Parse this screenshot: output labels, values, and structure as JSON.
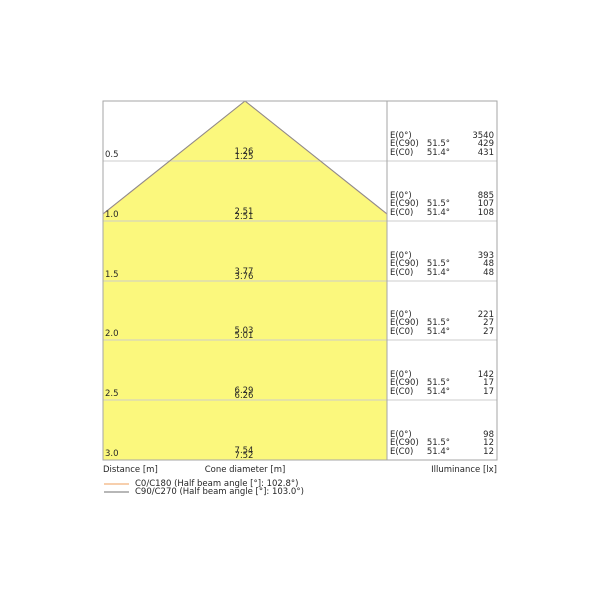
{
  "diagram": {
    "axis": {
      "distance_label": "Distance [m]",
      "cone_label": "Cone diameter [m]",
      "illuminance_label": "Illuminance [lx]"
    },
    "rows": [
      {
        "distance": "0.5",
        "cone_c90": "1.26",
        "cone_c0": "1.25",
        "e0_label": "E(0°)",
        "e0_value": "3540",
        "ec90_label": "E(C90)",
        "ec90_angle": "51.5°",
        "ec90_value": "429",
        "ec0_label": "E(C0)",
        "ec0_angle": "51.4°",
        "ec0_value": "431"
      },
      {
        "distance": "1.0",
        "cone_c90": "2.51",
        "cone_c0": "2.51",
        "e0_label": "E(0°)",
        "e0_value": "885",
        "ec90_label": "E(C90)",
        "ec90_angle": "51.5°",
        "ec90_value": "107",
        "ec0_label": "E(C0)",
        "ec0_angle": "51.4°",
        "ec0_value": "108"
      },
      {
        "distance": "1.5",
        "cone_c90": "3.77",
        "cone_c0": "3.76",
        "e0_label": "E(0°)",
        "e0_value": "393",
        "ec90_label": "E(C90)",
        "ec90_angle": "51.5°",
        "ec90_value": "48",
        "ec0_label": "E(C0)",
        "ec0_angle": "51.4°",
        "ec0_value": "48"
      },
      {
        "distance": "2.0",
        "cone_c90": "5.03",
        "cone_c0": "5.01",
        "e0_label": "E(0°)",
        "e0_value": "221",
        "ec90_label": "E(C90)",
        "ec90_angle": "51.5°",
        "ec90_value": "27",
        "ec0_label": "E(C0)",
        "ec0_angle": "51.4°",
        "ec0_value": "27"
      },
      {
        "distance": "2.5",
        "cone_c90": "6.29",
        "cone_c0": "6.26",
        "e0_label": "E(0°)",
        "e0_value": "142",
        "ec90_label": "E(C90)",
        "ec90_angle": "51.5°",
        "ec90_value": "17",
        "ec0_label": "E(C0)",
        "ec0_angle": "51.4°",
        "ec0_value": "17"
      },
      {
        "distance": "3.0",
        "cone_c90": "7.54",
        "cone_c0": "7.52",
        "e0_label": "E(0°)",
        "e0_value": "98",
        "ec90_label": "E(C90)",
        "ec90_angle": "51.5°",
        "ec90_value": "12",
        "ec0_label": "E(C0)",
        "ec0_angle": "51.4°",
        "ec0_value": "12"
      }
    ],
    "legend": [
      {
        "label": "C0/C180 (Half beam angle [°]: 102.8°)",
        "color": "#f2b27c"
      },
      {
        "label": "C90/C270 (Half beam angle [°]: 103.0°)",
        "color": "#8c8c8c"
      }
    ],
    "colors": {
      "cone_fill": "#fbf87d",
      "c0_line": "#f2b27c",
      "c90_line": "#8c8c8c"
    }
  },
  "chart_data": {
    "type": "area",
    "title": "Luminous cone diagram",
    "axis_labels": [
      "Distance [m]",
      "Cone diameter [m]",
      "Illuminance [lx]"
    ],
    "distance_m": [
      0.5,
      1.0,
      1.5,
      2.0,
      2.5,
      3.0
    ],
    "series": [
      {
        "name": "C0/C180",
        "half_beam_angle_deg": 102.8,
        "angle_label": "51.4°",
        "cone_diameter_m": [
          1.25,
          2.51,
          3.76,
          5.01,
          6.26,
          7.52
        ],
        "illuminance_lx": [
          431,
          108,
          48,
          27,
          17,
          17
        ],
        "color": "#f2b27c"
      },
      {
        "name": "C90/C270",
        "half_beam_angle_deg": 103.0,
        "angle_label": "51.5°",
        "cone_diameter_m": [
          1.26,
          2.51,
          3.77,
          5.03,
          6.29,
          7.54
        ],
        "illuminance_lx": [
          429,
          107,
          48,
          27,
          17,
          12
        ],
        "color": "#8c8c8c"
      },
      {
        "name": "E(0°)",
        "illuminance_lx": [
          3540,
          885,
          393,
          221,
          142,
          98
        ]
      }
    ],
    "grid": true,
    "legend_position": "bottom-left",
    "notes": "E(C0) values per row: 431, 108, 48, 27, 17, 12; E(C90): 429, 107, 48, 27, 17, 12; cone clipped to plot area below ~1.0 m"
  }
}
